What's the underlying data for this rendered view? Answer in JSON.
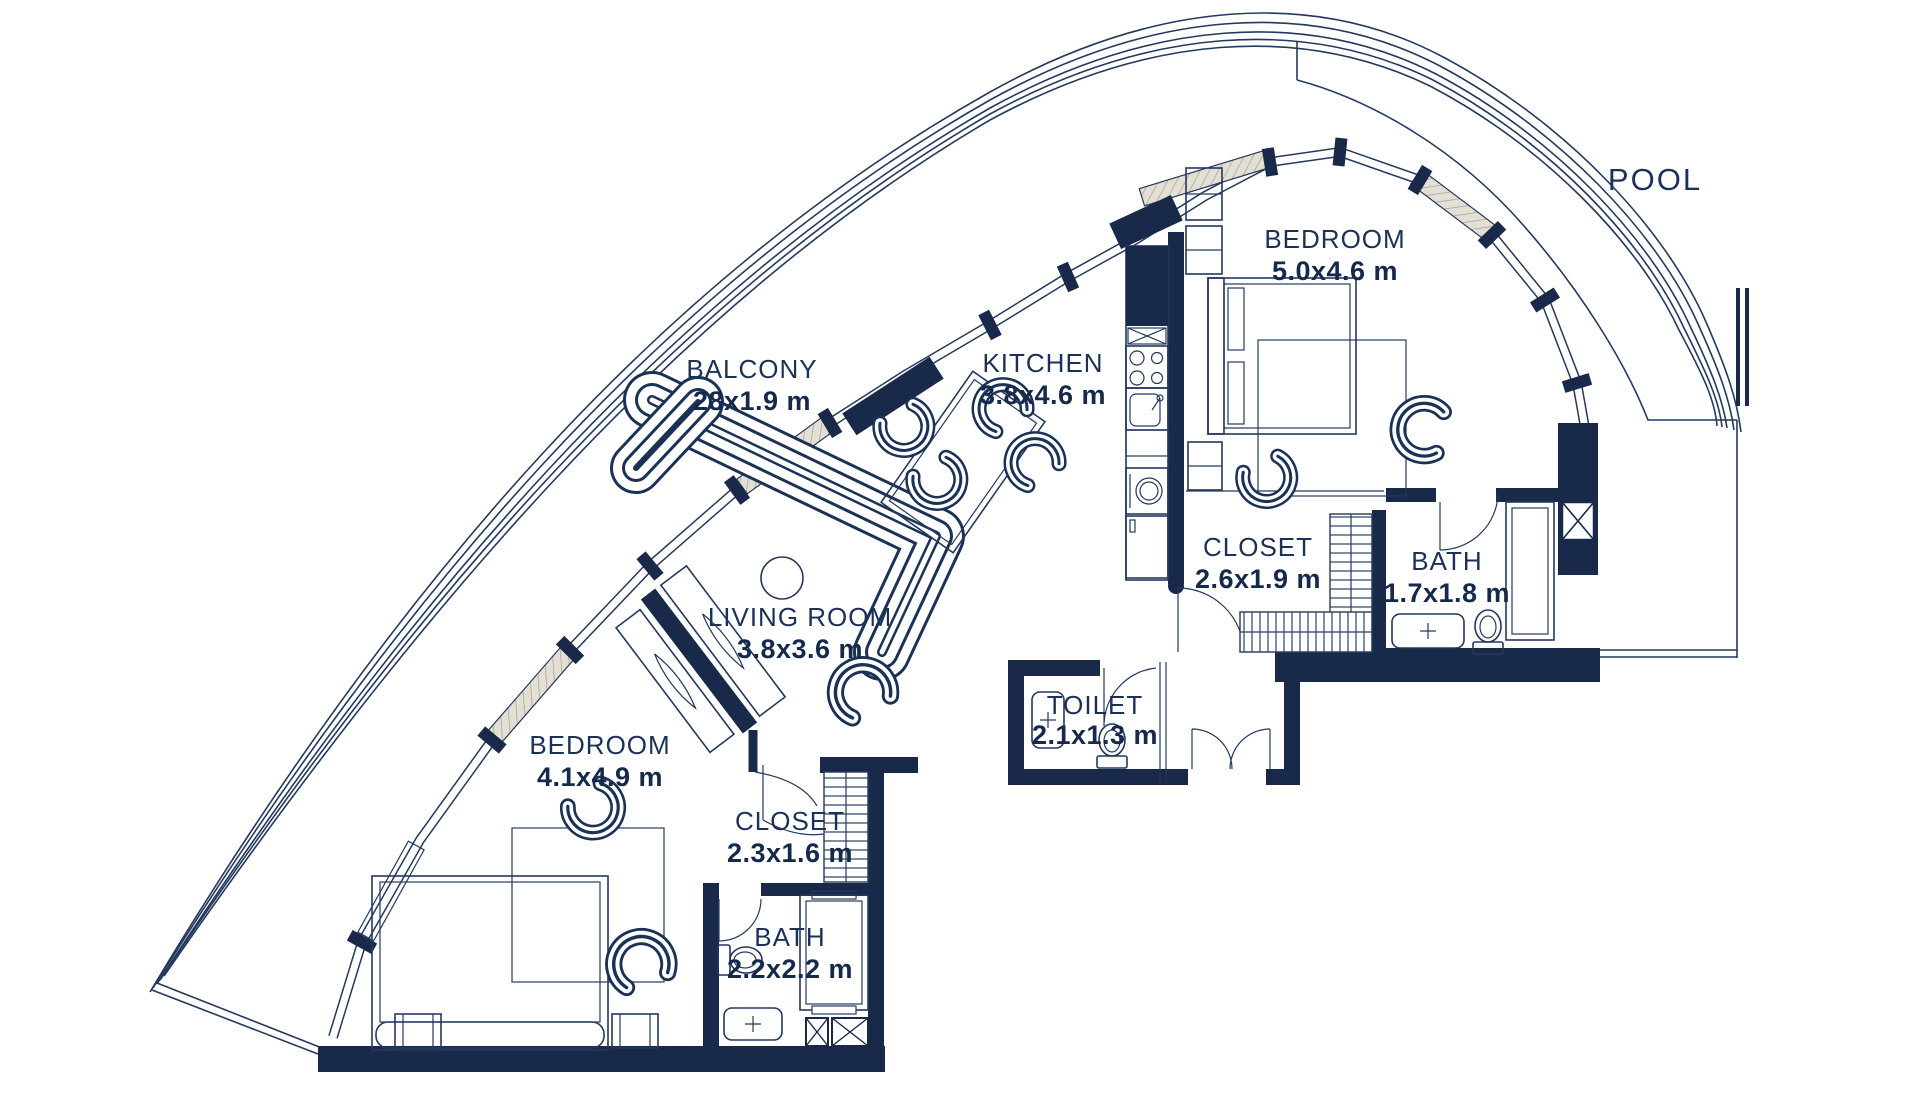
{
  "plan": {
    "pool_label": "POOL",
    "rooms": [
      {
        "id": "bedroom-1",
        "name": "BEDROOM",
        "dims": "5.0x4.6 m"
      },
      {
        "id": "kitchen",
        "name": "KITCHEN",
        "dims": "3.8x4.6 m"
      },
      {
        "id": "balcony",
        "name": "BALCONY",
        "dims": "28x1.9 m"
      },
      {
        "id": "living-room",
        "name": "LIVING ROOM",
        "dims": "3.8x3.6 m"
      },
      {
        "id": "closet-1",
        "name": "CLOSET",
        "dims": "2.6x1.9 m"
      },
      {
        "id": "bath-1",
        "name": "BATH",
        "dims": "1.7x1.8 m"
      },
      {
        "id": "toilet",
        "name": "TOILET",
        "dims": "2.1x1.3 m"
      },
      {
        "id": "bedroom-2",
        "name": "BEDROOM",
        "dims": "4.1x4.9 m"
      },
      {
        "id": "closet-2",
        "name": "CLOSET",
        "dims": "2.3x1.6 m"
      },
      {
        "id": "bath-2",
        "name": "BATH",
        "dims": "2.2x2.2 m"
      }
    ],
    "colors": {
      "wall": "#18294A",
      "line": "#24395E",
      "text": "#1B3156",
      "window_hatch": "#E4DFD5",
      "background": "#FFFFFF"
    }
  }
}
